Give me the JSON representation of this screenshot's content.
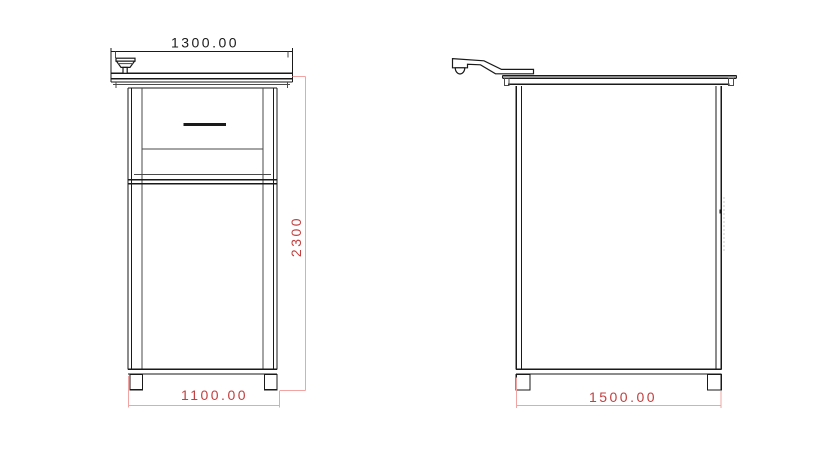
{
  "drawing": {
    "views": {
      "front": {
        "dimensions": {
          "top_width": {
            "label": "1300.00"
          },
          "height": {
            "label": "2300"
          },
          "base_width": {
            "label": "1100.00"
          }
        }
      },
      "side": {
        "dimensions": {
          "base_depth": {
            "label": "1500.00"
          }
        }
      }
    },
    "colors": {
      "line": "#1a1a1a",
      "thin_line": "#4a4a4a",
      "dimension_line": "#f2a3a3",
      "dimension_text": "#c43f3f",
      "background": "#ffffff"
    }
  }
}
